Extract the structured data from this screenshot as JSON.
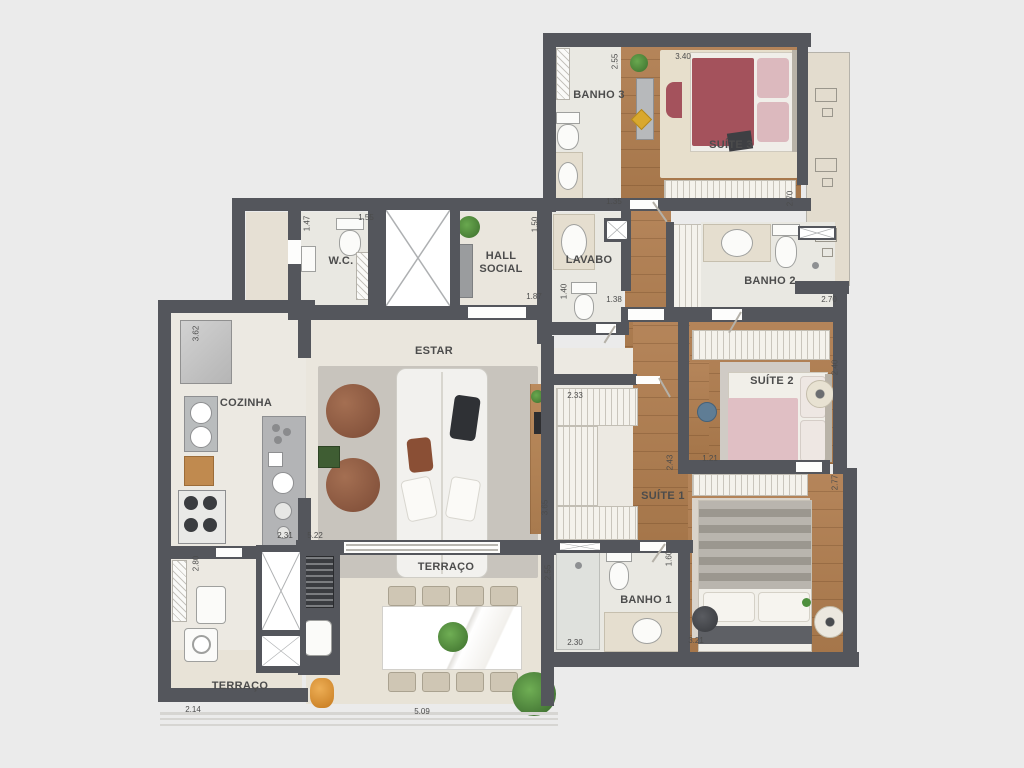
{
  "colors": {
    "bg": "#ebebeb",
    "wall": "#54565c",
    "floor": "#eae6dd",
    "bath": "#e9e8e2",
    "terr": "#e8e3d7",
    "wood": "#b08258",
    "carpet": "#e7dfcc",
    "rug": "#c8c4bd",
    "maroon": "#a4525c",
    "pink": "#e0bfc4",
    "brown": "#8a5a42",
    "plant": "#4e8f3e",
    "island": "#b3b4b6",
    "dimc": "#4c4c4c"
  },
  "rooms": {
    "banho3": {
      "label": "BANHO 3"
    },
    "suite3": {
      "label": "SUÍTE 3"
    },
    "wc": {
      "label": "W.C."
    },
    "hall_social": {
      "label": "HALL SOCIAL"
    },
    "lavabo": {
      "label": "LAVABO"
    },
    "banho2": {
      "label": "BANHO 2"
    },
    "estar": {
      "label": "ESTAR"
    },
    "cozinha": {
      "label": "COZINHA"
    },
    "suite2": {
      "label": "SUÍTE 2"
    },
    "suite1": {
      "label": "SUÍTE 1"
    },
    "banho1": {
      "label": "BANHO 1"
    },
    "terraco": {
      "label": "TERRAÇO"
    },
    "terraco_servico": {
      "label": "TERRAÇO"
    }
  },
  "dims": {
    "banho3_h": "2.55",
    "suite3_w": "3.40",
    "suite3_d": "2.70",
    "banho3_w": "1.35",
    "wc_h": "1.47",
    "wc_w": "1.55",
    "hall_h": "1.50",
    "hall_w": "1.87",
    "lavabo_h": "1.40",
    "lavabo_w": "1.38",
    "banho2_w": "2.70",
    "suite2_h": "2.40",
    "suite2_w": "1.21",
    "suite1_right_h": "2.77",
    "closet_w": "2.33",
    "suite1_mid_h": "2.43",
    "closet_h": "3.65",
    "banho1_h": "1.60",
    "banho1_w": "2.30",
    "suite1_w": "3.21",
    "cozinha_h": "3.62",
    "island_w": "2.31",
    "estar_w": "5.22",
    "servico_h": "2.80",
    "terraco_servico_w": "2.14",
    "terraco_w": "5.09",
    "terraco_h": "2.55"
  }
}
